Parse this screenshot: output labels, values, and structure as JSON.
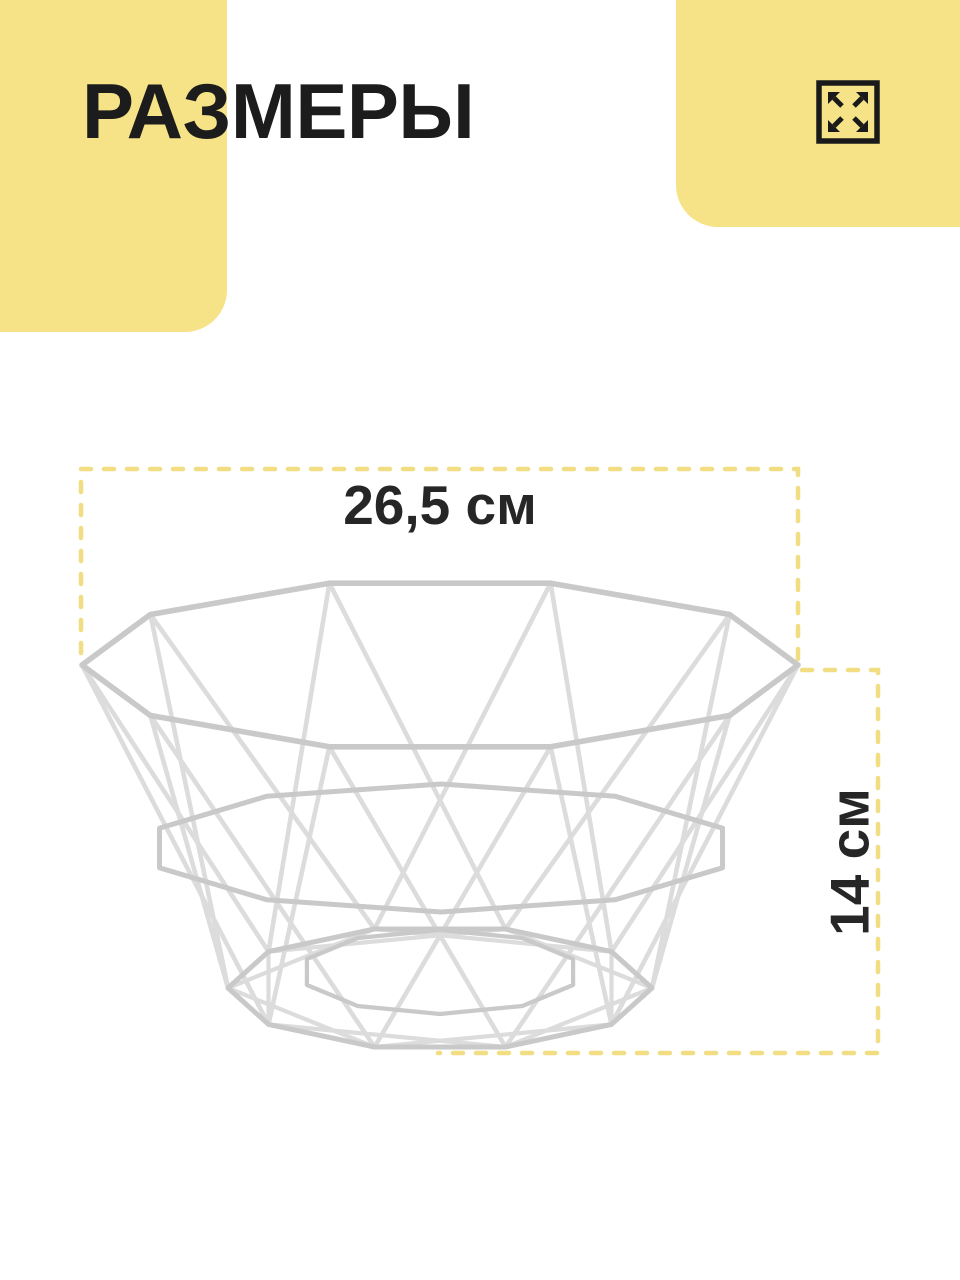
{
  "header": {
    "title": "РАЗМЕРЫ"
  },
  "dimensions": {
    "width_label": "26,5 см",
    "height_label": "14 см"
  },
  "icons": {
    "expand": "expand-icon",
    "illustration": "wire-basket"
  },
  "colors": {
    "accent_yellow": "#F6E388",
    "dash_yellow": "#F1DD82",
    "ink": "#1C1C1C",
    "wire_light": "#DCDCDC",
    "wire_mid": "#C9C9C9"
  }
}
